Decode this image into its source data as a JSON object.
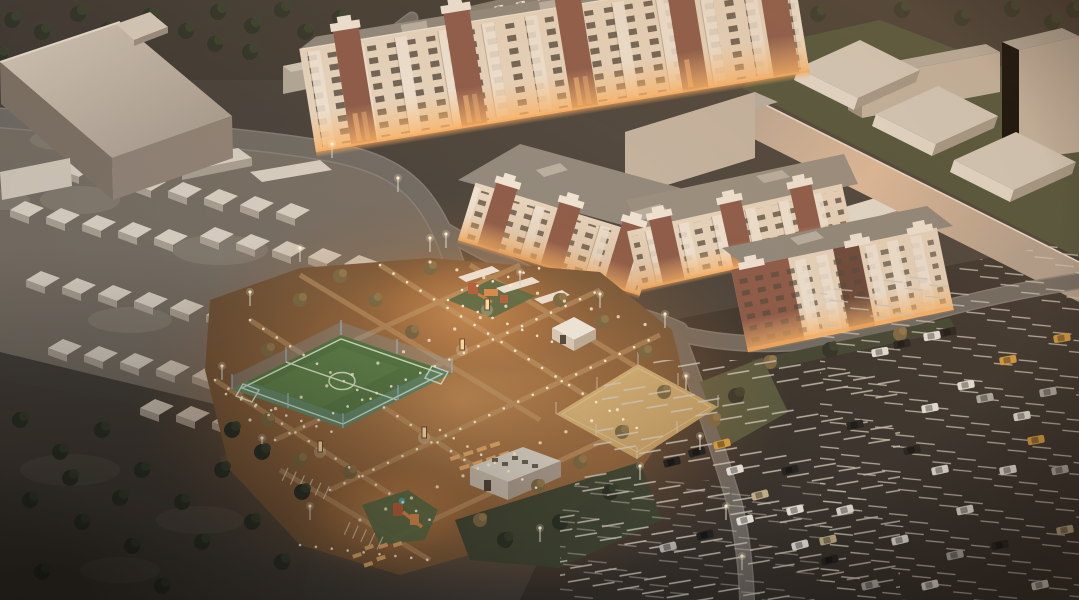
{
  "meta": {
    "type": "3d-architectural-aerial-render",
    "time_of_day": "dusk",
    "description": "Aerial dusk 3D render of a residential complex: long brick-and-beige apartment blocks with warmly lit lower windows, an illuminated landscaped courtyard with playgrounds, benches, a blue-fenced green football pitch and a sand sports court, rows of white gabled garages, warehouse sheds, a long windowless wall building, a large dark parking lot with white stall stripes and scattered cars, and dark tree belts around the edges."
  },
  "scene": {
    "objects": [
      {
        "name": "apartment-block-long",
        "floors": 9,
        "facade": "beige with brick towers, lit lower windows"
      },
      {
        "name": "apartment-block-l-shaped",
        "floors": 5,
        "facade": "beige with brick towers"
      },
      {
        "name": "apartment-block-east",
        "floors": 4,
        "facade": "brick and white balconies"
      },
      {
        "name": "industrial-slab-building",
        "floors": 1,
        "facade": "plain light concrete"
      },
      {
        "name": "windowless-wall-building",
        "facade": "warm peach light"
      },
      {
        "name": "garage-rows",
        "count": 8
      },
      {
        "name": "warehouse-sheds",
        "count": 3
      },
      {
        "name": "football-pitch",
        "surface": "green turf",
        "fence": "light blue mesh"
      },
      {
        "name": "sand-court",
        "surface": "sand"
      },
      {
        "name": "playgrounds",
        "count": 2
      },
      {
        "name": "pavilion",
        "count": 1
      },
      {
        "name": "technical-building",
        "count": 1
      },
      {
        "name": "parking-lot-cars",
        "approx_count": 35
      },
      {
        "name": "ground-lights",
        "description": "dotted path lighting across courtyard"
      }
    ]
  },
  "palette": {
    "bg": "#45403a",
    "topStrip": "#3e3933",
    "mottle": "#756d63",
    "mottleLight": "#8d857a",
    "forest": "#443e37",
    "forestLight": "#5d564c",
    "treeDark": "#2c3127",
    "treeDark2": "#39402f",
    "treeWarm": "#7c6843",
    "treeWarm2": "#93794e",
    "road": "#6e6a64",
    "roadEdge": "#86817a",
    "asphalt": "#37322d",
    "stall": "#cfc8bb",
    "slabRoofA": "#d2c6b6",
    "slabRoofB": "#a2968a",
    "slabFace": "#8f8276",
    "garage": "#d7cfc2",
    "garageShade": "#a89f92",
    "shed": "#d5cec2",
    "shedFront": "#e6dfd3",
    "shedShade": "#a39a8c",
    "grassTR": "#4a5039",
    "lawn": "#555a40",
    "hedge": "#3f4433",
    "bldgFace": "#e9d8c3",
    "brick": "#8a5848",
    "brickDark": "#684539",
    "balc": "#f2e8da",
    "winDark": "#4e4438",
    "winLit": "#ffc382",
    "glowCore": "#f0aa64",
    "turf": "#5a7a46",
    "turfLine": "#d8e6c8",
    "fence": "#8fb9d4",
    "fencePost": "#a9cde2",
    "sand": "#c7a268",
    "sandLight": "#dab87e",
    "pathTan": "#c89e6c",
    "lightDot": "#fff2d4",
    "roofGray": "#8e887e",
    "roofGray2": "#968e82",
    "roofLight": "#b8b0a4",
    "peachEdge": "#efe2d2",
    "plainBox": "#c4b6a6",
    "carWhite": "#ece8e0",
    "carBlack": "#232120",
    "carSilver": "#b5b1ab",
    "carYellow": "#d99e3e",
    "carTan": "#c9b68e",
    "pavilion": "#efe9dd",
    "play1": "#b55f3a",
    "play2": "#d98a4a",
    "playMat": "#5a6b46",
    "bench": "#e2a869"
  }
}
